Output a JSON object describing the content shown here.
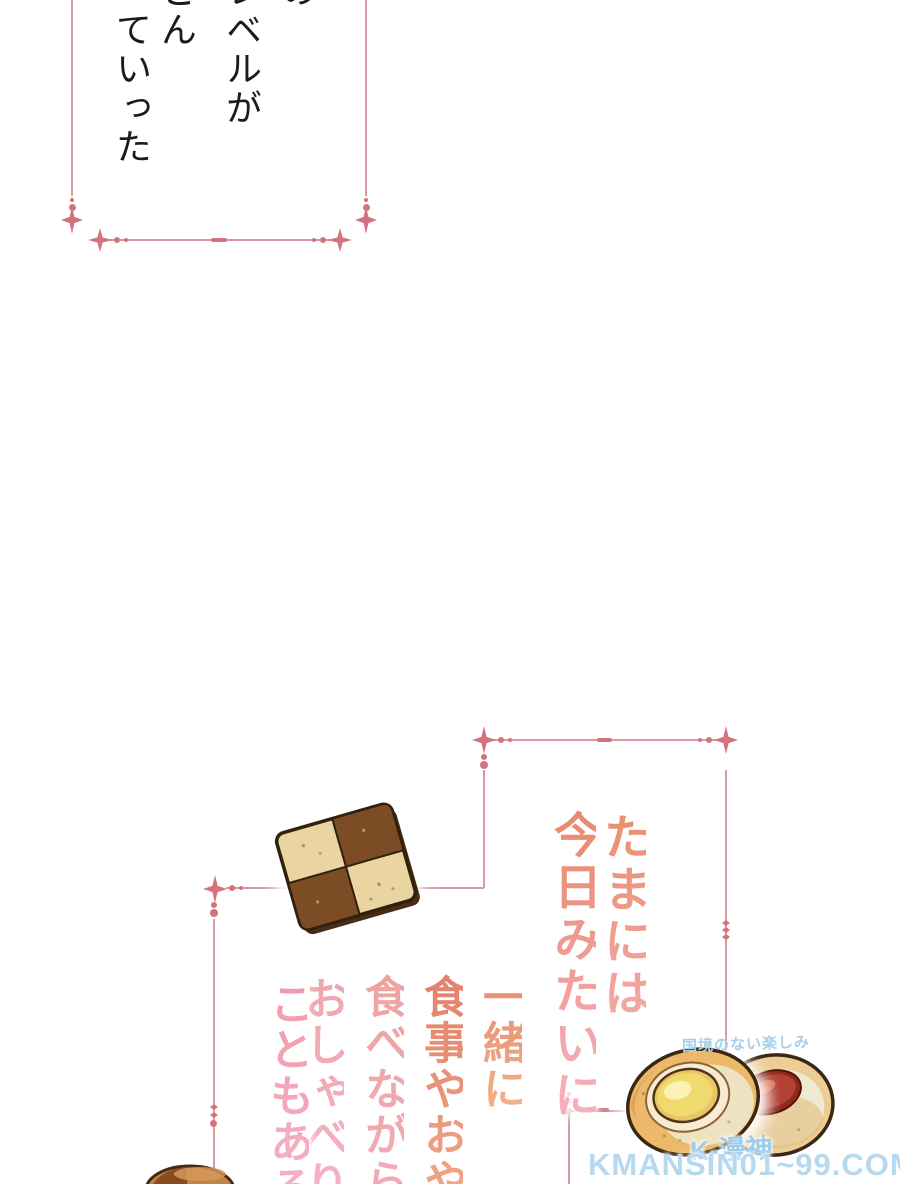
{
  "page": {
    "width": 900,
    "height": 1184,
    "background": "#ffffff"
  },
  "frame": {
    "line_color": "#dc98a0",
    "ornament_color": "#d4737d"
  },
  "narration": {
    "text_color": "#1b1b1b",
    "columns": [
      "の",
      "レベルが",
      "どん",
      "っていった"
    ]
  },
  "speech_1": {
    "columns": [
      "たまには",
      "今日みたいに"
    ],
    "color_top": "#e98e6f",
    "color_bottom": "#f5b0bf"
  },
  "speech_2": {
    "columns": [
      "一緒に",
      "食事やおや",
      "食べながら",
      "おしゃべり",
      "こともある"
    ],
    "color_top": "#e5866d",
    "color_bottom": "#f5b2c6"
  },
  "illustrations": {
    "checkered_cookie": {
      "light": "#ead5a0",
      "dark": "#7c4c24",
      "outline": "#30210f"
    },
    "lemon_thumbprint_cookie": {
      "base": "#ecb96b",
      "filling": "#f1da6d"
    },
    "jam_thumbprint_cookie": {
      "base": "#eccd96",
      "filling": "#b24334"
    },
    "partial_cookie": {
      "base": "#c08445"
    }
  },
  "watermark": {
    "tagline": "国境のない楽しみ",
    "logo_letter": "K",
    "logo_text": "K-漫神",
    "url": "KMANSIN01~99.COM",
    "color": "#aed4ee"
  }
}
